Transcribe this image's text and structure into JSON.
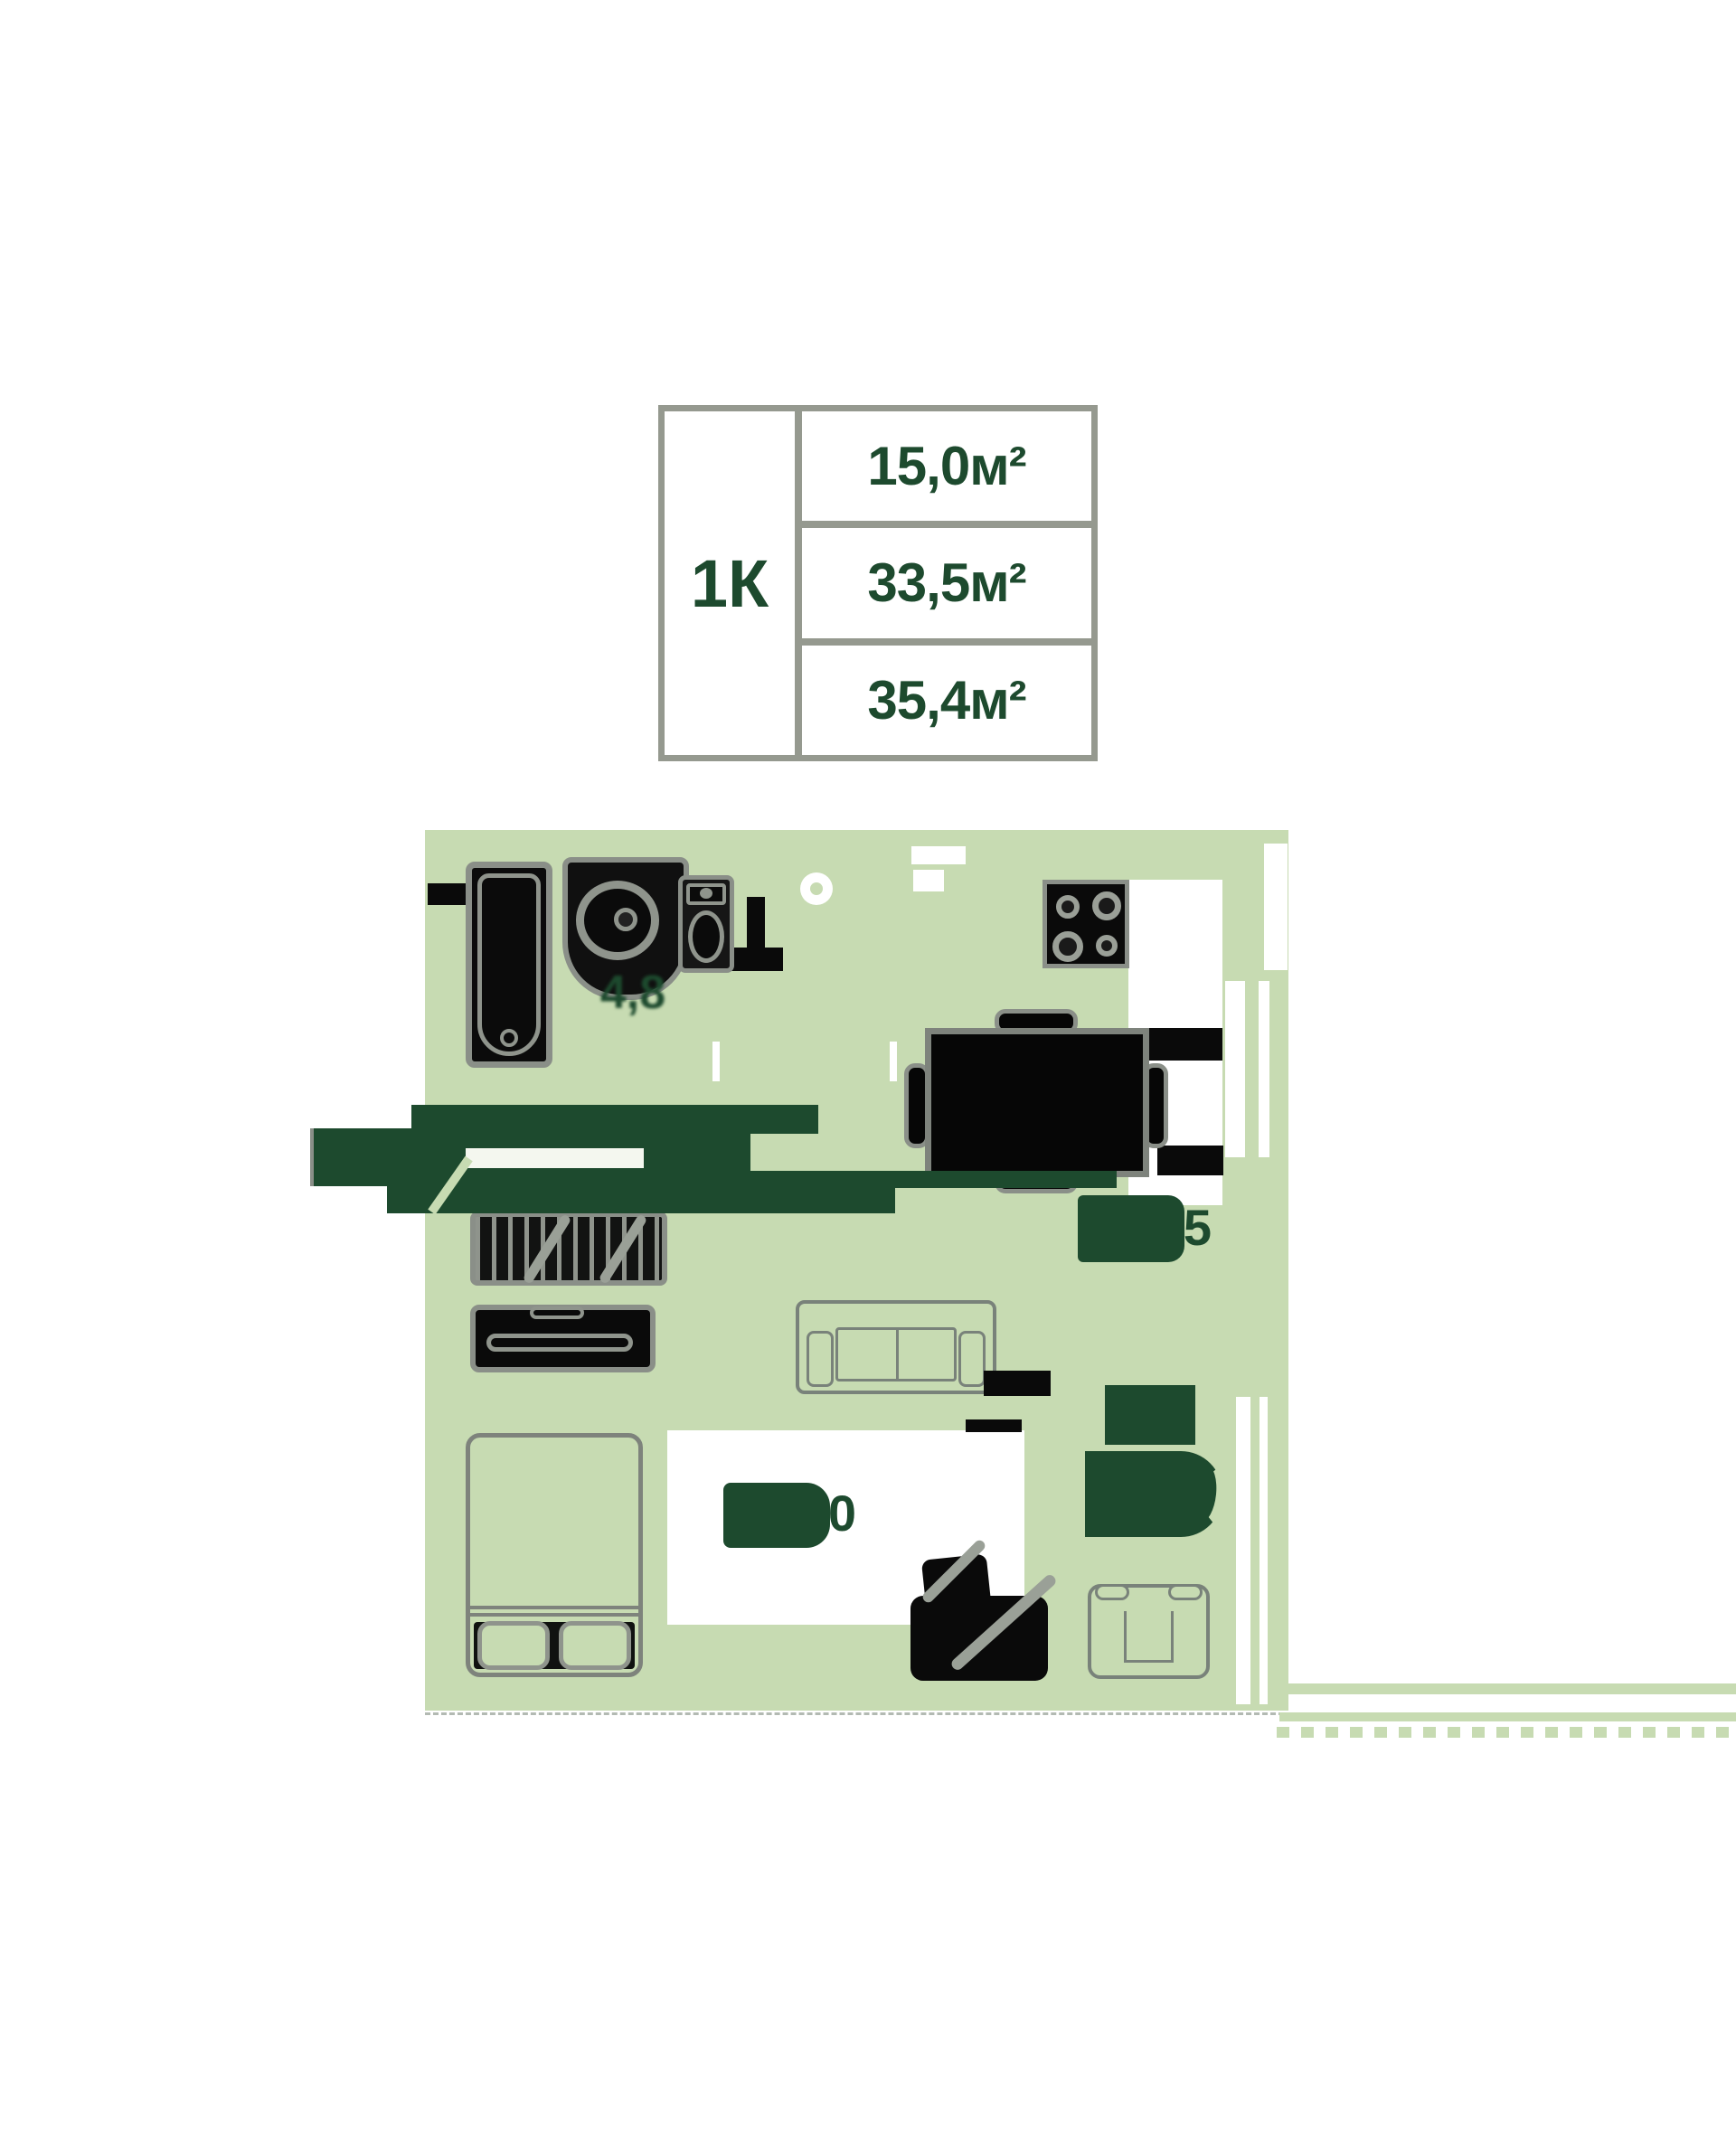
{
  "spec_table": {
    "type_label": "1К",
    "rows": [
      {
        "name": "room-area",
        "value": "15,0м²"
      },
      {
        "name": "living-area",
        "value": "33,5м²"
      },
      {
        "name": "total-area",
        "value": "35,4м²"
      }
    ]
  },
  "floor_plan": {
    "labels": {
      "bathroom": "4,8",
      "kitchen_living": "15,5",
      "bedroom": "15,0"
    },
    "rooms": [
      "bathroom",
      "kitchen-living-room",
      "bedroom"
    ],
    "furniture": [
      "bathtub",
      "washbasin",
      "toilet",
      "cooktop",
      "dining-table-with-chairs",
      "wardrobe",
      "dresser",
      "sofa",
      "double-bed",
      "desk-with-chair",
      "armchair",
      "washing-machine"
    ],
    "colors": {
      "floor": "#c7dbb2",
      "accent_green": "#1d4a2e",
      "furniture_gray": "#8a8f88",
      "furniture_black": "#0a0a0a"
    }
  }
}
